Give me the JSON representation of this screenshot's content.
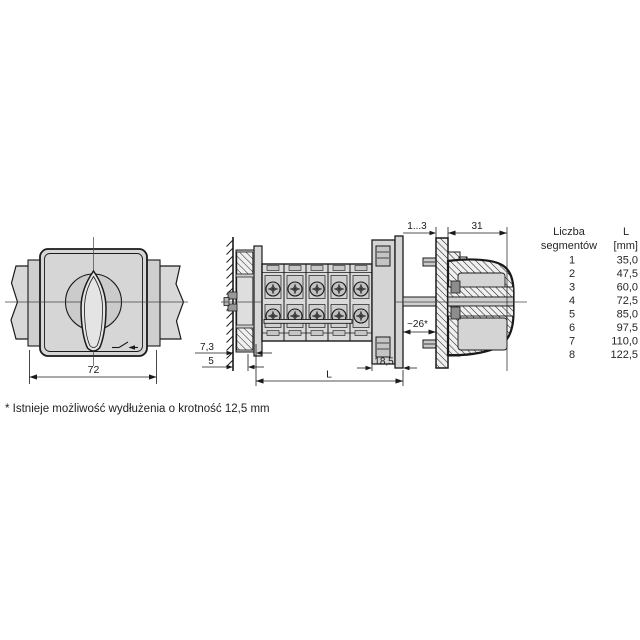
{
  "page": {
    "footnote": "* Istnieje możliwość wydłużenia o krotność 12,5 mm"
  },
  "drawing": {
    "front_view": {
      "width_label": "72"
    },
    "side_view": {
      "wall_gap_label": "7,3",
      "rail_gap_label": "5",
      "length_label": "L",
      "flange_depth_label": "18,5",
      "shaft_gap_label": "~26*"
    },
    "panel_view": {
      "panel_thickness_label": "1...3",
      "handle_depth_label": "31"
    }
  },
  "table": {
    "header": {
      "segments_line1": "Liczba",
      "segments_line2": "segmentów",
      "length_line1": "L",
      "length_line2": "[mm]"
    },
    "rows": [
      {
        "segments": "1",
        "length_mm": "35,0"
      },
      {
        "segments": "2",
        "length_mm": "47,5"
      },
      {
        "segments": "3",
        "length_mm": "60,0"
      },
      {
        "segments": "4",
        "length_mm": "72,5"
      },
      {
        "segments": "5",
        "length_mm": "85,0"
      },
      {
        "segments": "6",
        "length_mm": "97,5"
      },
      {
        "segments": "7",
        "length_mm": "110,0"
      },
      {
        "segments": "8",
        "length_mm": "122,5"
      }
    ]
  },
  "colors": {
    "line": "#1a1a1a",
    "fill_light": "#d8d8d8",
    "fill_mid": "#c9c9c9",
    "background": "#ffffff"
  },
  "icons": [
    {
      "name": "switch-contact-icon",
      "meaning": "cam switch contact symbol on faceplate"
    }
  ]
}
